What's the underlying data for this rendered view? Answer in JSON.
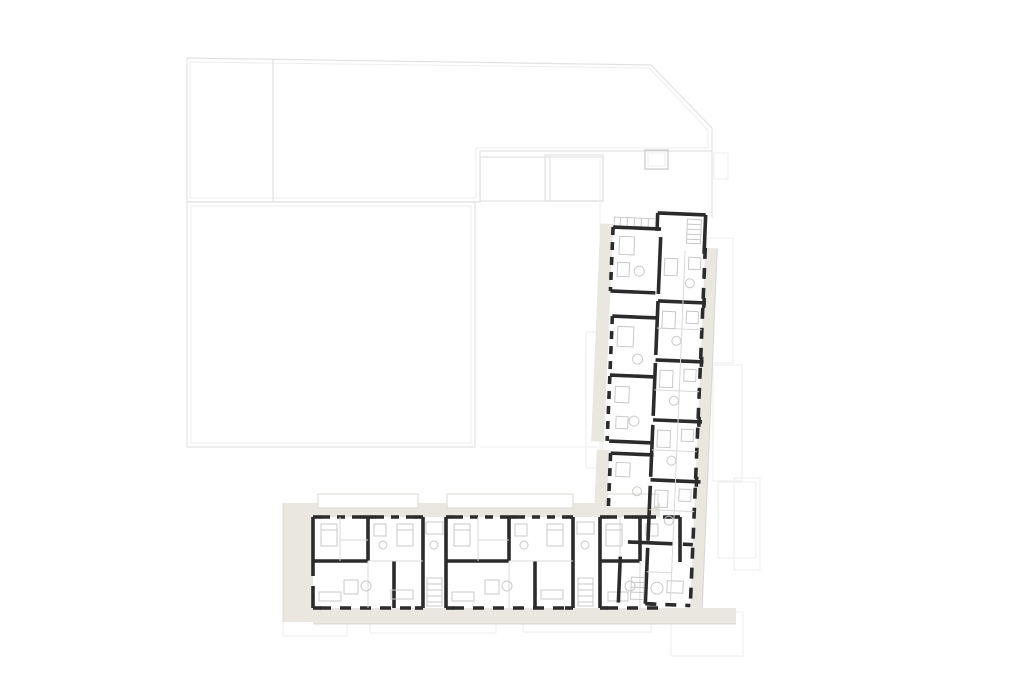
{
  "meta": {
    "kind": "architectural floor plan",
    "subject": "L-shaped residential building with site context outlines"
  },
  "colors": {
    "bg": "#ffffff",
    "wall": "#2b2b2b",
    "ctx": "#e2e2e2",
    "ctx_soft": "#ededed",
    "ctx_strong": "#c9c9c9",
    "balc": "#e9e7e0",
    "balc_edge": "#d9d7cf",
    "part": "#d9d9d9",
    "furn": "#c9c9c9"
  },
  "plan": {
    "wings": [
      {
        "name": "south-wing",
        "visible_unit_modules": 3
      },
      {
        "name": "east-wing",
        "visible_room_rows": 6,
        "west_room_clusters": 3
      }
    ],
    "site_context_parcels": 3,
    "stairwells_visible": 3
  }
}
